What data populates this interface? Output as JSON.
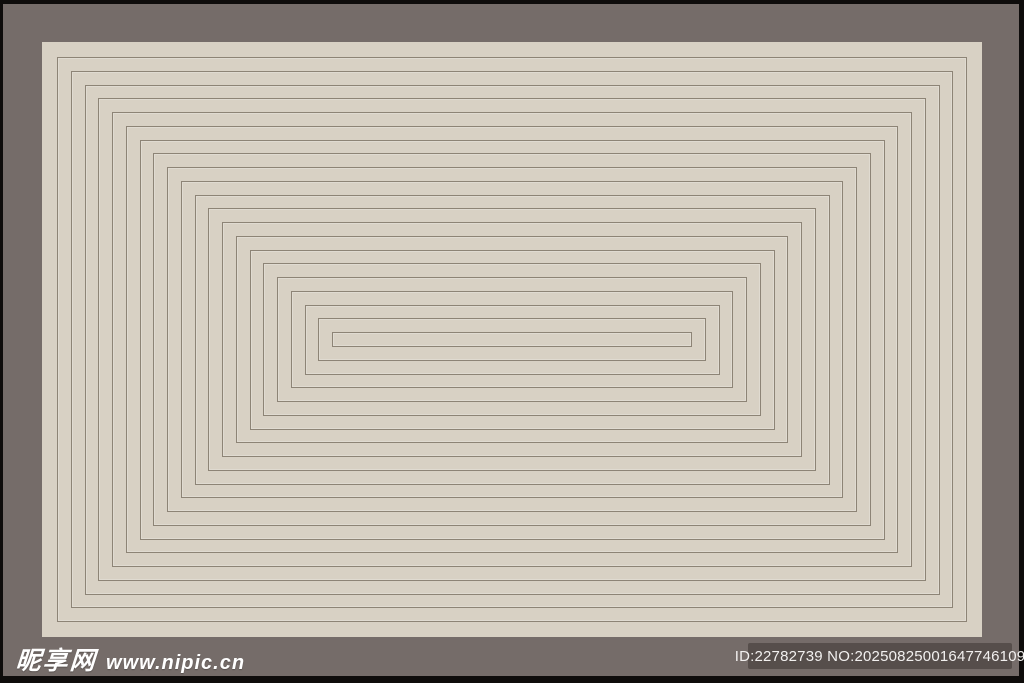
{
  "artwork": {
    "description": "concentric-rectangles-line-pattern",
    "ring_count": 21,
    "first_inset_px": 15,
    "ring_step_px": 13.75,
    "colors": {
      "outer_frame": "#0e0c0b",
      "background": "#756c69",
      "panel": "#d8d1c4",
      "line": "#8d8476",
      "badge": "#564e4b",
      "watermark_text": "#ffffff"
    }
  },
  "watermark": {
    "site_name": "昵享网",
    "site_url": "www.nipic.cn",
    "id_label": "ID:22782739 NO:20250825001647746109"
  }
}
